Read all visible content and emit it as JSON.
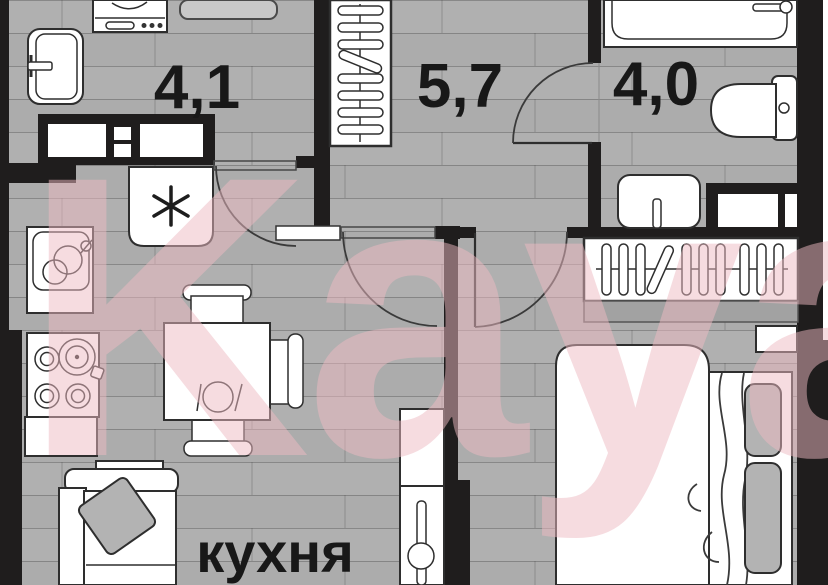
{
  "plan": {
    "type": "apartment-floor-plan",
    "watermark": "Kayan",
    "rooms": [
      {
        "id": "utility",
        "label": "4,1"
      },
      {
        "id": "hallway",
        "label": "5,7"
      },
      {
        "id": "bathroom",
        "label": "4,0"
      },
      {
        "id": "kitchen",
        "label": "кухня"
      }
    ],
    "colors": {
      "wall": "#1f1d1d",
      "floor": "#acacac",
      "label": "#181818",
      "watermark": "#eebac2",
      "fixture": "#ffffff"
    }
  }
}
